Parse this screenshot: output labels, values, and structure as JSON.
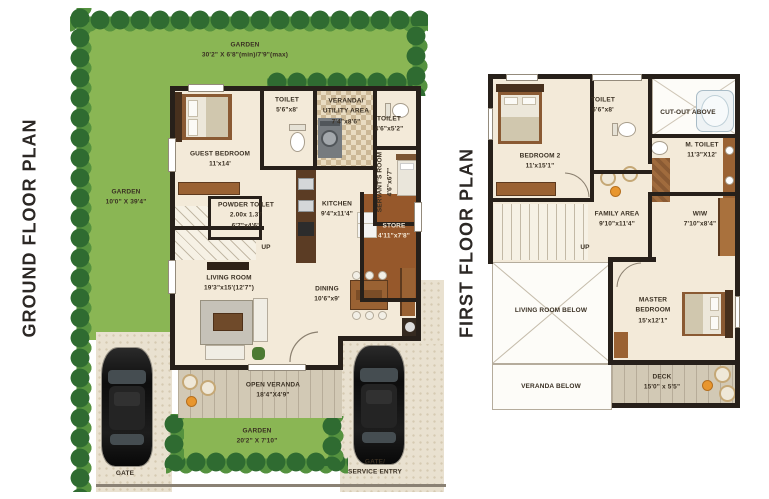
{
  "titles": {
    "ground": "GROUND FLOOR PLAN",
    "first": "FIRST FLOOR PLAN"
  },
  "ground": {
    "garden_top": {
      "name": "GARDEN",
      "dims": "30'2\" X 6'8\"(min)/7'9\"(max)"
    },
    "garden_left": {
      "name": "GARDEN",
      "dims": "10'0\" X 39'4\""
    },
    "guest_bedroom": {
      "name": "GUEST BEDROOM",
      "dims": "11'x14'"
    },
    "toilet_1": {
      "name": "TOILET",
      "dims": "5'6\"x8'"
    },
    "veranda_utility": {
      "name": "VERANDA/",
      "name2": "UTILITY AREA",
      "dims": "7'4\"x8'6\""
    },
    "toilet_2": {
      "name": "TOILET",
      "dims": "4'6\"x5'2\""
    },
    "servants_room": {
      "name": "SERVANT'S ROOM",
      "dims": "4'6\"x6'7\""
    },
    "powder_toilet": {
      "name": "POWDER TOILET",
      "dims_metric": "2.00x 1.37",
      "dims": "6'7\"x4'6\""
    },
    "kitchen": {
      "name": "KITCHEN",
      "dims": "9'4\"x11'4\""
    },
    "store": {
      "name": "STORE",
      "dims": "4'11\"x7'8\""
    },
    "stairs_label": "UP",
    "living_room": {
      "name": "LIVING ROOM",
      "dims": "19'3\"x15'(12'7\")"
    },
    "dining": {
      "name": "DINING",
      "dims": "10'6\"x9'"
    },
    "open_veranda": {
      "name": "OPEN VERANDA",
      "dims": "18'4\"X4'9\""
    },
    "garden_front": {
      "name": "GARDEN",
      "dims": "20'2\" X 7'10\""
    },
    "gate": "GATE",
    "gate_service": {
      "line1": "GATE/",
      "line2": "SERVICE ENTRY"
    }
  },
  "first": {
    "bedroom_2": {
      "name": "BEDROOM 2",
      "dims": "11'x15'1\""
    },
    "toilet": {
      "name": "TOILET",
      "dims": "6'6\"x8'"
    },
    "cut_out": "CUT-OUT ABOVE",
    "m_toilet": {
      "name": "M. TOILET",
      "dims": "11'3\"X12'"
    },
    "family_area": {
      "name": "FAMILY AREA",
      "dims": "9'10\"x11'4\""
    },
    "wiw": {
      "name": "WIW",
      "dims": "7'10\"x8'4\""
    },
    "stairs_label": "UP",
    "living_below": "LIVING ROOM BELOW",
    "master_bedroom": {
      "name": "MASTER",
      "name2": "BEDROOM",
      "dims": "15'x12'1\""
    },
    "veranda_below": "VERANDA BELOW",
    "deck": {
      "name": "DECK",
      "dims": "15'0\" x 5'5\""
    }
  },
  "colors": {
    "background": "#ffffff",
    "garden_green": "#8ab654",
    "tree_dark": "#2f6b31",
    "tree_light": "#55923f",
    "floor_cream": "#f3ead9",
    "wall_dark": "#27201a",
    "wood_brown": "#9a6233",
    "store_brown": "#96582b",
    "tile_beige": "#e9e1d0",
    "plank_grey": "#d2c9b5",
    "accent_orange": "#e8962e",
    "car_black": "#161616",
    "label_text": "#3a3023",
    "title_text": "#2c2825"
  }
}
